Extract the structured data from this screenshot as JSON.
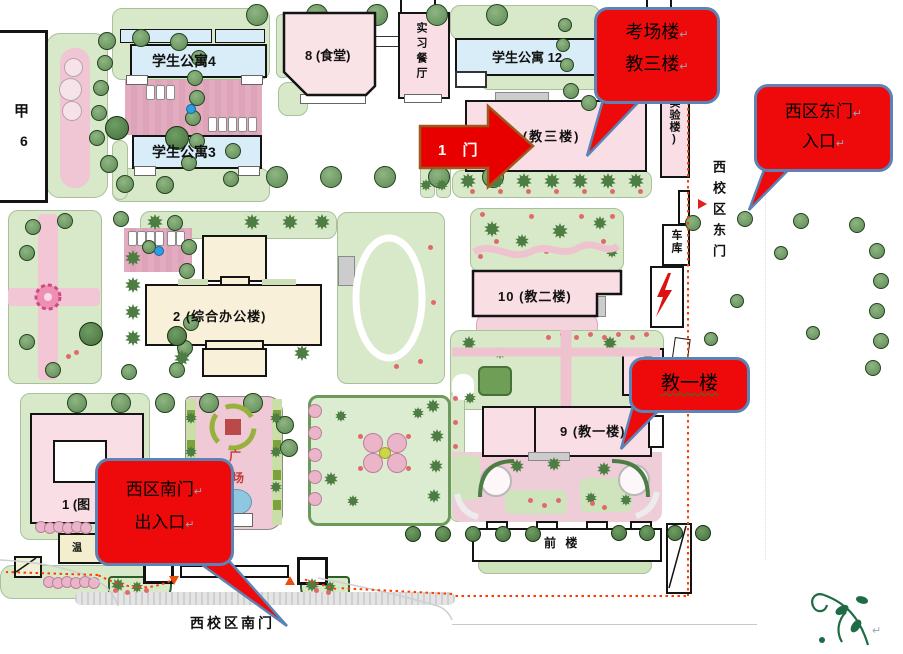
{
  "callouts": {
    "exam": {
      "line1": "考场楼",
      "line2": "教三楼"
    },
    "east_gate": {
      "line1": "西区东门",
      "line2": "入口"
    },
    "jiao1_label": "教一楼",
    "south_gate": {
      "line1": "西区南门",
      "line2": "出入口"
    },
    "return_mark": "↵"
  },
  "arrow": {
    "label": "1 门"
  },
  "buildings": {
    "jia_line1": "甲",
    "jia_line2": "6",
    "apt4": "学生公寓4",
    "apt3": "学生公寓3",
    "canteen": "8 (食堂)",
    "practice_restaurant": "实习餐厅",
    "apt12": "学生公寓 12",
    "jiao3": "1 (教三楼)",
    "lab": "(实验楼)",
    "garage": "车库",
    "jiao2": "10 (教二楼)",
    "office": "2 (综合办公楼)",
    "bldg1": "1 (图",
    "greenhouse": "温",
    "jiao1": "9 (教一楼)",
    "front": "前 楼"
  },
  "gates": {
    "east": "西校区东门",
    "south": "西校区南门"
  },
  "plaza": {
    "char1": "广",
    "char2": "场"
  },
  "colors": {
    "callout_red": "#ee0a0a",
    "callout_border": "#5b83b5",
    "route_red": "#ff3c00",
    "arrow_border": "#9c5a1e"
  }
}
